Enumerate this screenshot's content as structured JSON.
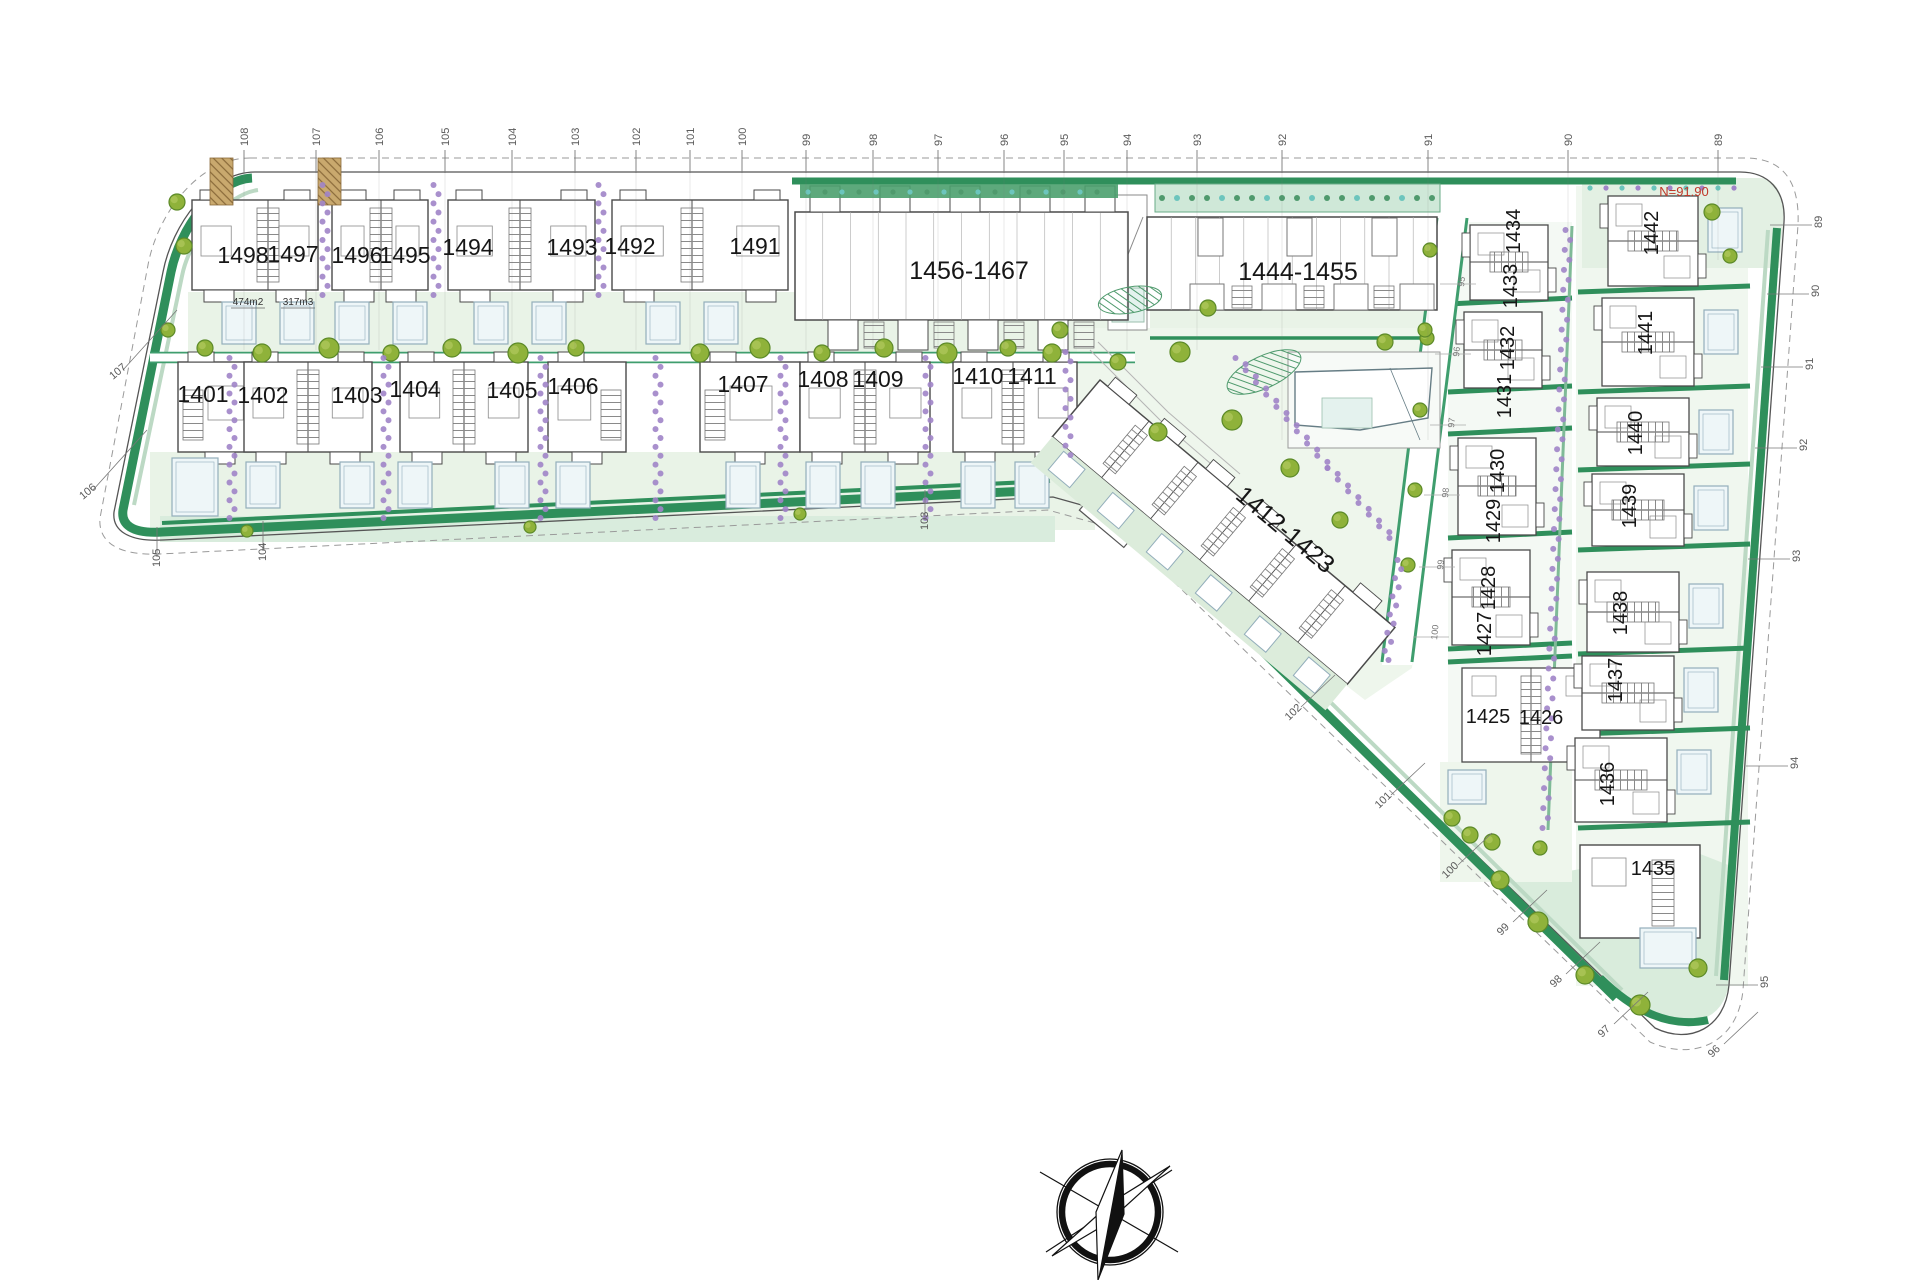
{
  "drawing": {
    "type": "residential masterplan site plan",
    "accent_green": "#2f8f5b",
    "pale_green": "#e9f3e7",
    "purple_hedge": "#a084c8",
    "pool_blue": "#eef6f8"
  },
  "plot_labels": {
    "row1": [
      {
        "id": "1498",
        "x": 243,
        "y": 263
      },
      {
        "id": "1497",
        "x": 293,
        "y": 262
      },
      {
        "id": "1496",
        "x": 357,
        "y": 263
      },
      {
        "id": "1495",
        "x": 405,
        "y": 263
      },
      {
        "id": "1494",
        "x": 468,
        "y": 255
      },
      {
        "id": "1493",
        "x": 572,
        "y": 255
      },
      {
        "id": "1492",
        "x": 630,
        "y": 254
      },
      {
        "id": "1491",
        "x": 755,
        "y": 254
      }
    ],
    "row2": [
      {
        "id": "1401",
        "x": 203,
        "y": 402
      },
      {
        "id": "1402",
        "x": 263,
        "y": 403
      },
      {
        "id": "1403",
        "x": 357,
        "y": 403
      },
      {
        "id": "1404",
        "x": 415,
        "y": 397
      },
      {
        "id": "1405",
        "x": 512,
        "y": 398
      },
      {
        "id": "1406",
        "x": 573,
        "y": 394
      },
      {
        "id": "1407",
        "x": 743,
        "y": 392
      },
      {
        "id": "1408",
        "x": 823,
        "y": 387
      },
      {
        "id": "1409",
        "x": 878,
        "y": 387
      },
      {
        "id": "1410",
        "x": 978,
        "y": 384
      },
      {
        "id": "1411",
        "x": 1032,
        "y": 384
      }
    ],
    "inner_column_vertical": [
      {
        "id": "1434",
        "x": 1520,
        "y": 231
      },
      {
        "id": "1433",
        "x": 1517,
        "y": 286
      },
      {
        "id": "1432",
        "x": 1514,
        "y": 348
      },
      {
        "id": "1431",
        "x": 1511,
        "y": 396
      },
      {
        "id": "1430",
        "x": 1504,
        "y": 471
      },
      {
        "id": "1429",
        "x": 1500,
        "y": 521
      },
      {
        "id": "1428",
        "x": 1495,
        "y": 588
      },
      {
        "id": "1427",
        "x": 1491,
        "y": 634
      }
    ],
    "inner_column_horizontal": [
      {
        "id": "1425",
        "x": 1488,
        "y": 723
      },
      {
        "id": "1426",
        "x": 1541,
        "y": 724
      }
    ],
    "outer_column_vertical": [
      {
        "id": "1442",
        "x": 1658,
        "y": 233
      },
      {
        "id": "1441",
        "x": 1652,
        "y": 333
      },
      {
        "id": "1440",
        "x": 1642,
        "y": 433
      },
      {
        "id": "1439",
        "x": 1636,
        "y": 506
      },
      {
        "id": "1438",
        "x": 1627,
        "y": 613
      },
      {
        "id": "1437",
        "x": 1622,
        "y": 680
      },
      {
        "id": "1436",
        "x": 1614,
        "y": 784
      }
    ],
    "outer_column_horizontal": [
      {
        "id": "1435",
        "x": 1653,
        "y": 875
      }
    ]
  },
  "block_labels": [
    {
      "id": "1456-1467",
      "x": 969,
      "y": 279,
      "rot": 0
    },
    {
      "id": "1444-1455",
      "x": 1298,
      "y": 280,
      "rot": 0
    },
    {
      "id": "1412-1423",
      "x": 1280,
      "y": 536,
      "rot": 40
    }
  ],
  "area_labels": [
    {
      "text": "474m2",
      "x": 248,
      "y": 305
    },
    {
      "text": "317m3",
      "x": 298,
      "y": 305
    }
  ],
  "elevation_note": {
    "text": "N=91.90",
    "x": 1684,
    "y": 196,
    "color": "#c0392b"
  },
  "contour_labels": {
    "top": [
      {
        "label": "108",
        "x": 244
      },
      {
        "label": "107",
        "x": 316
      },
      {
        "label": "106",
        "x": 379
      },
      {
        "label": "105",
        "x": 445
      },
      {
        "label": "104",
        "x": 512
      },
      {
        "label": "103",
        "x": 575
      },
      {
        "label": "102",
        "x": 636
      },
      {
        "label": "101",
        "x": 690
      },
      {
        "label": "100",
        "x": 742
      },
      {
        "label": "99",
        "x": 806
      },
      {
        "label": "98",
        "x": 873
      },
      {
        "label": "97",
        "x": 938
      },
      {
        "label": "96",
        "x": 1004
      },
      {
        "label": "95",
        "x": 1064
      },
      {
        "label": "94",
        "x": 1127
      },
      {
        "label": "93",
        "x": 1197
      },
      {
        "label": "92",
        "x": 1282
      },
      {
        "label": "91",
        "x": 1428
      },
      {
        "label": "90",
        "x": 1568
      },
      {
        "label": "89",
        "x": 1718
      }
    ],
    "left": [
      {
        "label": "107",
        "x": 113,
        "y": 380
      },
      {
        "label": "106",
        "x": 83,
        "y": 500
      }
    ],
    "bottom": [
      {
        "label": "105",
        "x": 157,
        "y": 567
      },
      {
        "label": "104",
        "x": 263,
        "y": 561
      },
      {
        "label": "103",
        "x": 925,
        "y": 530
      }
    ],
    "diagonal": [
      {
        "label": "102",
        "x": 1289,
        "y": 721
      },
      {
        "label": "101",
        "x": 1379,
        "y": 809
      },
      {
        "label": "100",
        "x": 1446,
        "y": 879
      },
      {
        "label": "99",
        "x": 1501,
        "y": 936
      },
      {
        "label": "98",
        "x": 1554,
        "y": 988
      },
      {
        "label": "97",
        "x": 1602,
        "y": 1038
      },
      {
        "label": "96",
        "x": 1712,
        "y": 1058
      }
    ],
    "right": [
      {
        "label": "95",
        "x": 1768,
        "y": 988
      },
      {
        "label": "94",
        "x": 1798,
        "y": 769
      },
      {
        "label": "93",
        "x": 1800,
        "y": 562
      },
      {
        "label": "92",
        "x": 1807,
        "y": 451
      },
      {
        "label": "91",
        "x": 1813,
        "y": 370
      },
      {
        "label": "90",
        "x": 1819,
        "y": 297
      },
      {
        "label": "89",
        "x": 1822,
        "y": 228
      }
    ]
  },
  "road_markers": [
    {
      "label": "95",
      "x": 1464,
      "y": 287
    },
    {
      "label": "96",
      "x": 1459,
      "y": 357
    },
    {
      "label": "97",
      "x": 1454,
      "y": 428
    },
    {
      "label": "98",
      "x": 1448,
      "y": 498
    },
    {
      "label": "99",
      "x": 1443,
      "y": 570
    },
    {
      "label": "100",
      "x": 1437,
      "y": 640
    }
  ],
  "compass": {
    "name": "north-compass-rose"
  }
}
